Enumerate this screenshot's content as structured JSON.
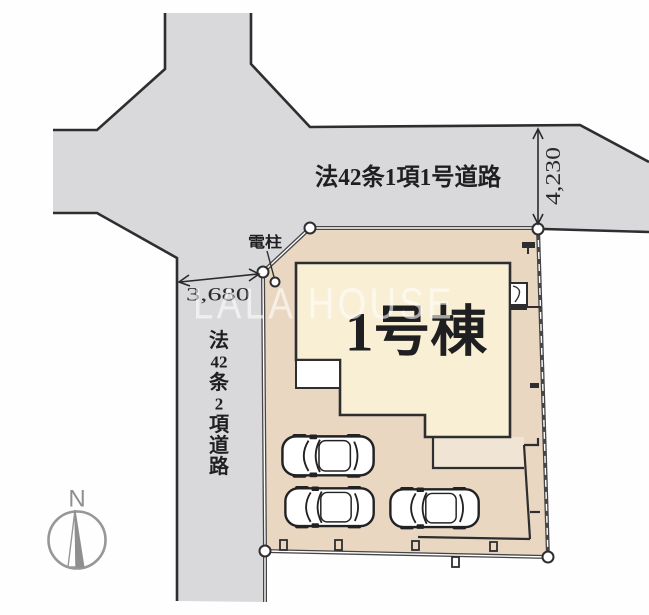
{
  "watermark": {
    "text": "LALA HOUSE"
  },
  "site_plan": {
    "building": {
      "label": "1号棟"
    },
    "roads": {
      "north": {
        "label": "法42条1項1号道路",
        "width_dimension": "4,230"
      },
      "west": {
        "label": "法42条2項道路",
        "label_chars": [
          "法",
          "42",
          "条",
          "2",
          "項",
          "道",
          "路"
        ],
        "width_dimension": "3,680"
      }
    },
    "utility_pole_label": "電柱",
    "compass": {
      "north_label": "N"
    },
    "parking": {
      "car_count": 3
    },
    "colors": {
      "road_fill": "#d9d9db",
      "lot_fill": "#e9d7c1",
      "building_fill": "#f9efd5",
      "outline": "#2e2e30",
      "boundary": "#454548",
      "compass_gray": "#97979a",
      "watermark_white": "#ffffff"
    }
  }
}
